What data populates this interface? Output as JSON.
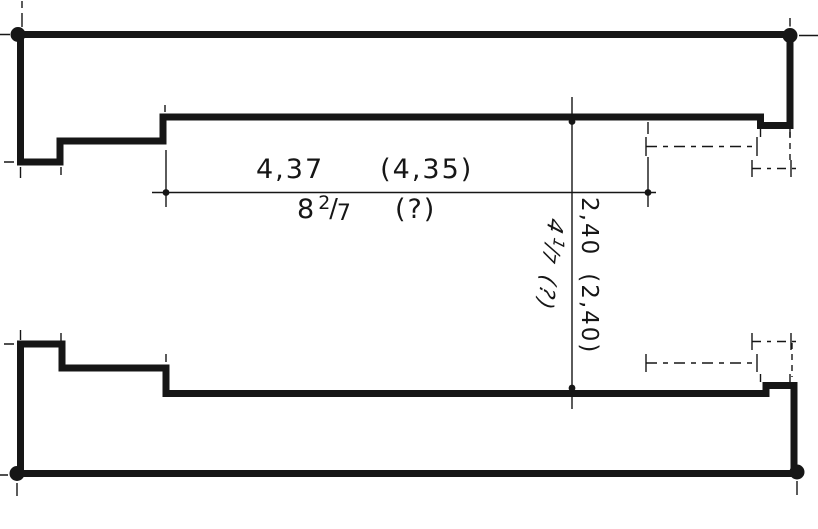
{
  "colors": {
    "ink": "#161616",
    "paper": "#ffffff"
  },
  "dimensions": {
    "horizontal": {
      "value": "4,37",
      "value_alt": "(4,35)",
      "fraction": {
        "whole": "8",
        "numerator": "2",
        "slash": "/",
        "denominator": "7"
      },
      "fraction_alt": "(?)"
    },
    "vertical": {
      "value": "2,40",
      "value_alt": "(2,40)",
      "fraction": {
        "whole": "4",
        "numerator": "1",
        "slash": "/",
        "denominator": "7"
      },
      "fraction_alt": "(?)"
    }
  }
}
